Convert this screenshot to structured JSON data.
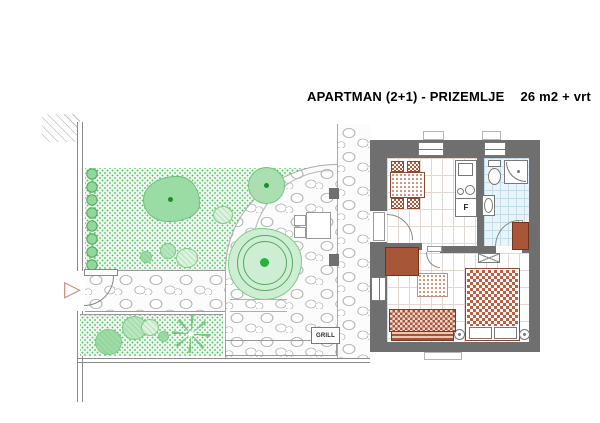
{
  "title": {
    "name": "APARTMAN (2+1) - PRIZEMLJE",
    "area": "26 m2 + vrt"
  },
  "labels": {
    "grill": "GRILL",
    "fridge": "F"
  },
  "colors": {
    "wall": "#6f6f6f",
    "wood_furniture": "#a85638",
    "upholstery_red": "#b4573b",
    "lawn_fill": "#edf9ee",
    "lawn_dot": "#5fbe72",
    "tree_fill": "#9bdca4",
    "tree_dot": "#1d8c2c",
    "bath_tile": "#eaf5fb",
    "stone_outline": "#b5b5b5",
    "tile_line": "#e2d8d1"
  },
  "plan_features": {
    "garden": [
      "lawn",
      "hedge-row",
      "trees",
      "bushes",
      "palm-plant",
      "cobblestone-patio",
      "garden-path",
      "outdoor-dining-set",
      "pergola-posts",
      "grill",
      "entrance-gate"
    ],
    "apartment": [
      "dining-table-with-four-chairs",
      "kitchen-counter",
      "hob-and-sink",
      "fridge",
      "bathroom-toilet",
      "bathroom-washbasin",
      "shower-cabin",
      "double-bed",
      "pillows",
      "bedside-lamps",
      "sofa",
      "rug",
      "wardrobes",
      "ac-unit",
      "windows",
      "doors"
    ]
  }
}
